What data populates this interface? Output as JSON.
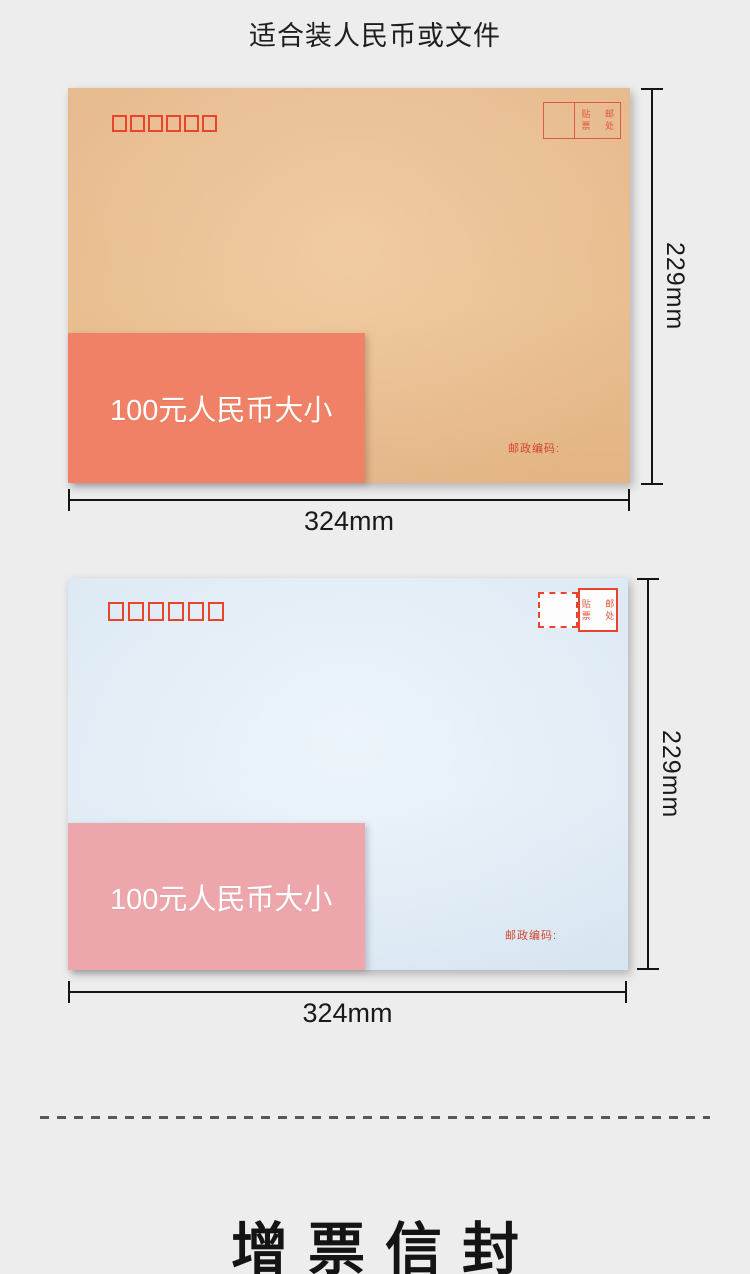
{
  "header": {
    "title": "适合装人民币或文件"
  },
  "envelopes": [
    {
      "overlay_label": "100元人民币大小",
      "postcode_label": "邮政编码:",
      "stamp": {
        "row1": "贴 邮",
        "row2": "票 处"
      },
      "height_label": "229mm",
      "width_label": "324mm",
      "colors": {
        "paper": "#eec192",
        "overlay": "#f08066"
      }
    },
    {
      "overlay_label": "100元人民币大小",
      "postcode_label": "邮政编码:",
      "stamp": {
        "row1": "贴 邮",
        "row2": "票 处"
      },
      "height_label": "229mm",
      "width_label": "324mm",
      "colors": {
        "paper": "#e1edf8",
        "overlay": "#eda7ac"
      }
    }
  ],
  "footer": {
    "title": "增票信封"
  },
  "colors": {
    "background": "#ededee",
    "accent_red": "#e8452b",
    "dimension_line": "#151515"
  }
}
